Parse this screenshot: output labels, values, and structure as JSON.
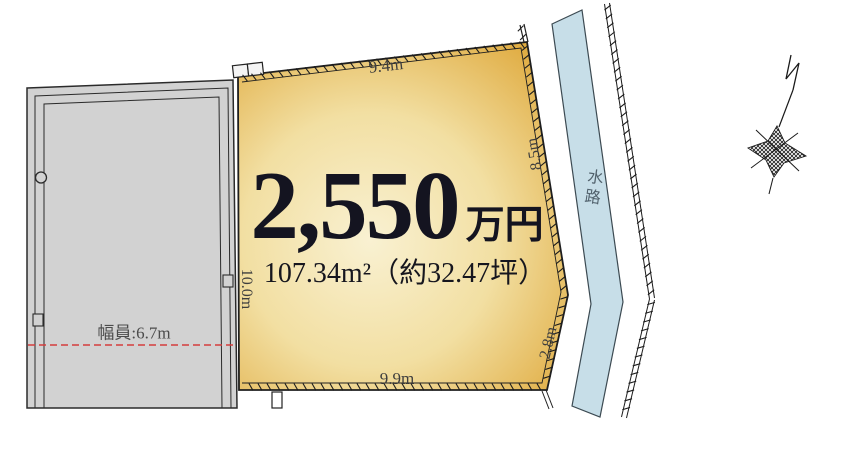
{
  "plot": {
    "price_main": "2,550",
    "price_unit": "万円",
    "area": "107.34m²（約32.47坪）",
    "dim_top": "9.4m",
    "dim_right": "8.5m",
    "dim_left": "10.0m",
    "dim_cut": "2.8m",
    "dim_bottom": "9.9m"
  },
  "road": {
    "width_label": "幅員:6.7m"
  },
  "waterway": {
    "label": "水路"
  },
  "colors": {
    "plot_edge": "#dfa93c",
    "plot_mid": "#f2dfa2",
    "plot_center": "#f9f1d2",
    "road": "#d2d2d2",
    "water": "#c7dee8",
    "dashed_red": "#d43c3c",
    "line": "#1f1f1f"
  }
}
